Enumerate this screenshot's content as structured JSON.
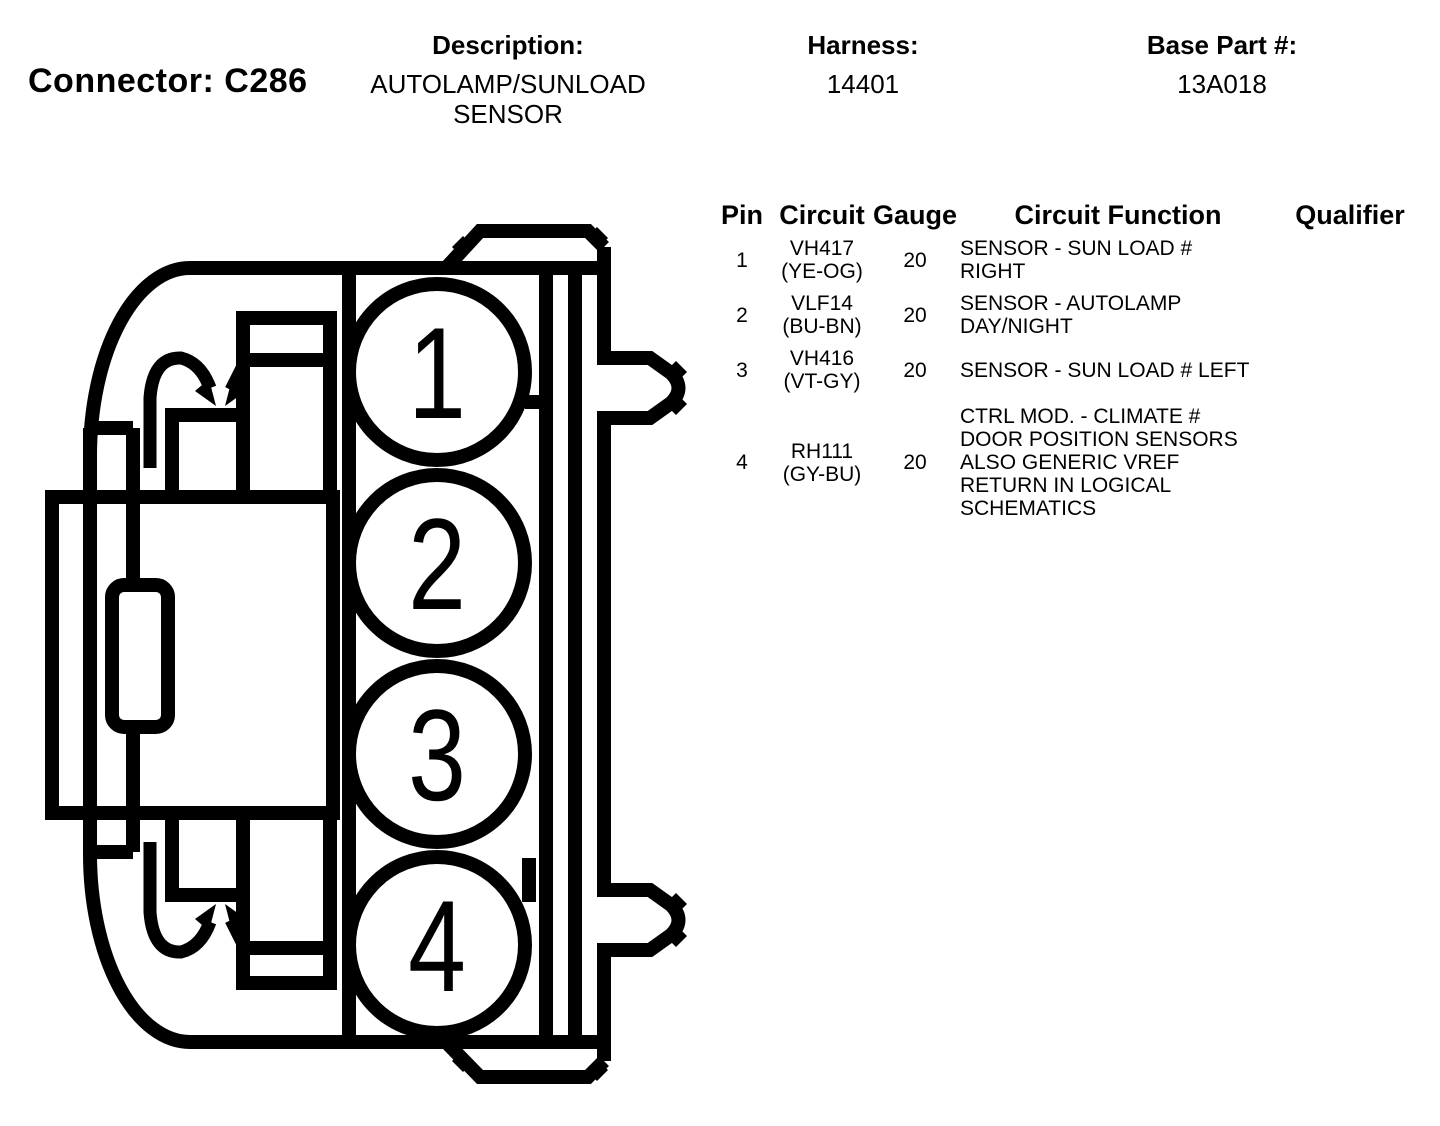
{
  "header": {
    "connector_label": "Connector: C286",
    "description_label": "Description:",
    "description_line1": "AUTOLAMP/SUNLOAD",
    "description_line2": "SENSOR",
    "harness_label": "Harness:",
    "harness_value": "14401",
    "base_part_label": "Base Part #:",
    "base_part_value": "13A018"
  },
  "diagram": {
    "name": "connector C286 side-view pinout drawing",
    "pin_labels": [
      "1",
      "2",
      "3",
      "4"
    ],
    "ink_color": "#000000",
    "background_color": "#ffffff"
  },
  "pin_table": {
    "columns": [
      "Pin",
      "Circuit",
      "Gauge",
      "Circuit Function",
      "Qualifier"
    ],
    "rows": [
      {
        "pin": "1",
        "circuit_id": "VH417",
        "circuit_color": "(YE-OG)",
        "gauge": "20",
        "function_lines": [
          "SENSOR - SUN LOAD #",
          "RIGHT"
        ],
        "qualifier": ""
      },
      {
        "pin": "2",
        "circuit_id": "VLF14",
        "circuit_color": "(BU-BN)",
        "gauge": "20",
        "function_lines": [
          "SENSOR - AUTOLAMP",
          "DAY/NIGHT"
        ],
        "qualifier": ""
      },
      {
        "pin": "3",
        "circuit_id": "VH416",
        "circuit_color": "(VT-GY)",
        "gauge": "20",
        "function_lines": [
          "SENSOR - SUN LOAD # LEFT"
        ],
        "qualifier": ""
      },
      {
        "pin": "4",
        "circuit_id": "RH111",
        "circuit_color": "(GY-BU)",
        "gauge": "20",
        "function_lines": [
          "CTRL MOD. - CLIMATE #",
          "DOOR POSITION SENSORS",
          "ALSO GENERIC VREF",
          "RETURN IN LOGICAL",
          "SCHEMATICS"
        ],
        "qualifier": ""
      }
    ]
  }
}
